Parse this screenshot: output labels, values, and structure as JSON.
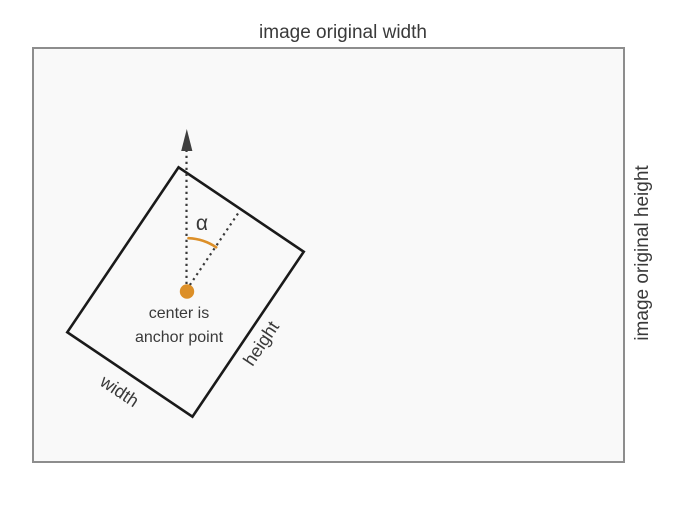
{
  "diagram": {
    "top_label": "image original width",
    "right_label": "image original height",
    "angle_label": "α",
    "center_label_line1": "center is",
    "center_label_line2": "anchor point",
    "box_width_label": "width",
    "box_height_label": "height",
    "colors": {
      "accent_orange": "#dc8f28",
      "text_dark": "#3a3a3a",
      "box_border": "#1a1a1a",
      "frame_border": "#8d8d8d",
      "frame_fill": "#f9f9f9"
    }
  }
}
